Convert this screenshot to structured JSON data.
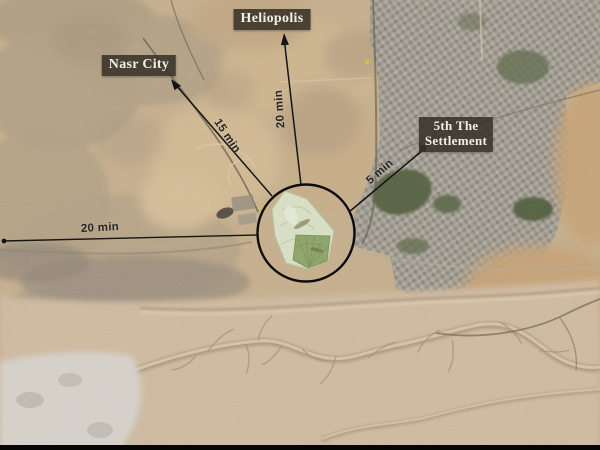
{
  "map": {
    "type": "annotated-satellite-map",
    "subject": "Circled development site in east Cairo with drive-time leader lines",
    "place_labels": [
      {
        "id": "heliopolis",
        "text": "Heliopolis"
      },
      {
        "id": "nasr-city",
        "text": "Nasr City"
      },
      {
        "id": "fifth-settlement",
        "line1": "5th The",
        "line2": "Settlement"
      }
    ],
    "travel_times": [
      {
        "to": "heliopolis",
        "text": "20 min"
      },
      {
        "to": "nasr-city",
        "text": "15 min"
      },
      {
        "to": "west",
        "text": "20 min"
      },
      {
        "to": "fifth-settlement",
        "text": "5 min"
      }
    ],
    "colors": {
      "label_background": "#39322a",
      "label_text": "#f2efe6",
      "annotation_line": "#151515",
      "highlight_circle": "#0c0c0c",
      "time_text": "#262626",
      "desert_base": "#c7af8b",
      "desert_light": "#d1bca1",
      "urban_gray": "#9e9a91",
      "urban_tan": "#b4a184",
      "vegetation_green": "#4c5a39",
      "development_green_light": "#dce6cb",
      "development_green_dark": "#89a361",
      "quarry_white": "#d9d6cf"
    }
  }
}
